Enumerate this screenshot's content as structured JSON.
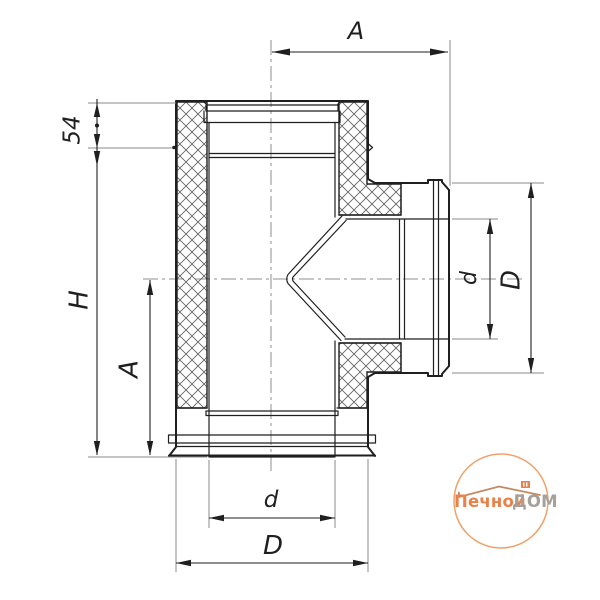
{
  "drawing": {
    "dimensions": {
      "top_width": "A",
      "collar_height": "54",
      "total_height": "H",
      "axis_to_bottom": "A",
      "branch_inner_diameter": "d",
      "branch_outer_diameter": "D",
      "bottom_inner_diameter": "d",
      "bottom_outer_diameter": "D"
    },
    "colors": {
      "line": "#1f1f1f",
      "extension": "#8a8a8a",
      "background": "#ffffff"
    }
  },
  "logo": {
    "brand_primary": "Печной",
    "brand_secondary": "ДОМ",
    "accent": "#e8824b",
    "secondary_color": "#a5a09c",
    "circle_color": "#efa06b"
  }
}
